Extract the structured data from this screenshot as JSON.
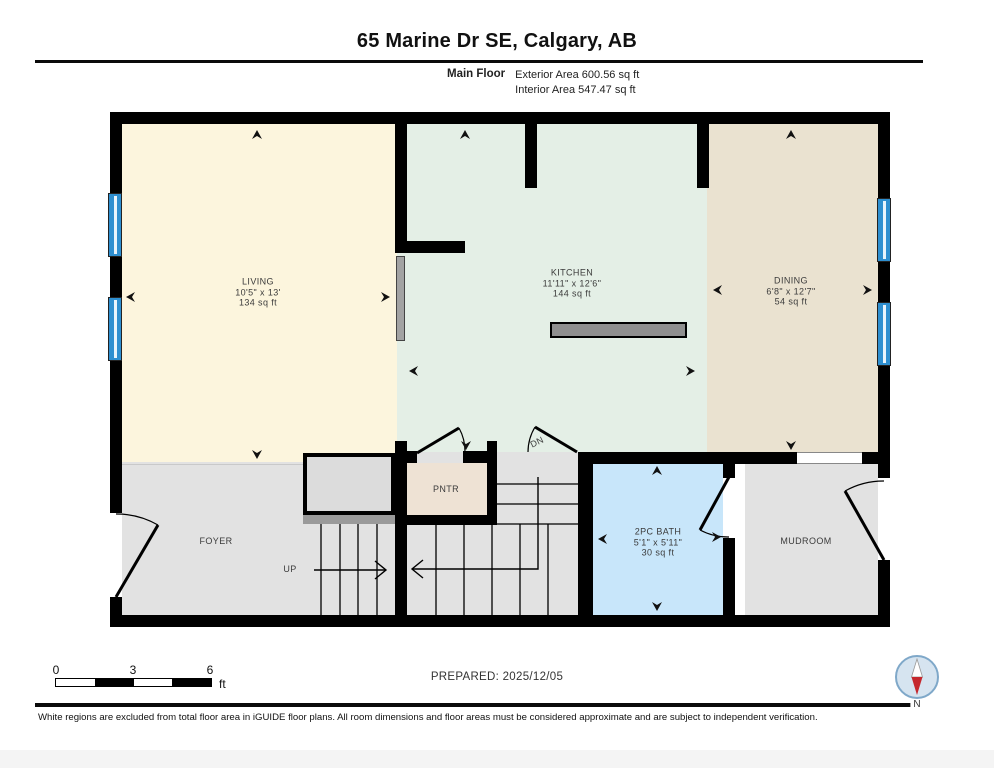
{
  "header": {
    "title": "65 Marine Dr SE, Calgary, AB",
    "floor_label": "Main Floor",
    "exterior_area": "Exterior Area 600.56 sq ft",
    "interior_area": "Interior Area 547.47 sq ft"
  },
  "rooms": {
    "living": {
      "name": "LIVING",
      "dims": "10'5\" x 13'",
      "area": "134 sq ft"
    },
    "kitchen": {
      "name": "KITCHEN",
      "dims": "11'11\" x 12'6\"",
      "area": "144 sq ft"
    },
    "dining": {
      "name": "DINING",
      "dims": "6'8\" x 12'7\"",
      "area": "54 sq ft"
    },
    "bath": {
      "name": "2PC BATH",
      "dims": "5'1\" x 5'11\"",
      "area": "30 sq ft"
    },
    "foyer": {
      "name": "FOYER"
    },
    "pantry": {
      "name": "PNTR"
    },
    "mudroom": {
      "name": "MUDROOM"
    },
    "stairs_up": {
      "label": "UP"
    },
    "stairs_down": {
      "label": "DN"
    }
  },
  "scale_bar": {
    "tick0": "0",
    "tick3": "3",
    "tick6": "6",
    "unit": "ft"
  },
  "footer": {
    "prepared": "PREPARED: 2025/12/05",
    "compass_label": "N",
    "disclaimer": "White regions are excluded from total floor area in iGUIDE floor plans. All room dimensions and floor areas must be considered approximate and are subject to independent verification."
  },
  "colors": {
    "wall": "#000000",
    "living": "#fcf5dd",
    "kitchen": "#e4efe6",
    "dining": "#eae2d0",
    "circulation_gray": "#e2e2e2",
    "bath_blue": "#c8e6fa",
    "pantry_beige": "#eee2d4",
    "window_blue": "#2e8fd0",
    "compass_red": "#c5272d",
    "compass_ring": "#7fa8c9"
  }
}
